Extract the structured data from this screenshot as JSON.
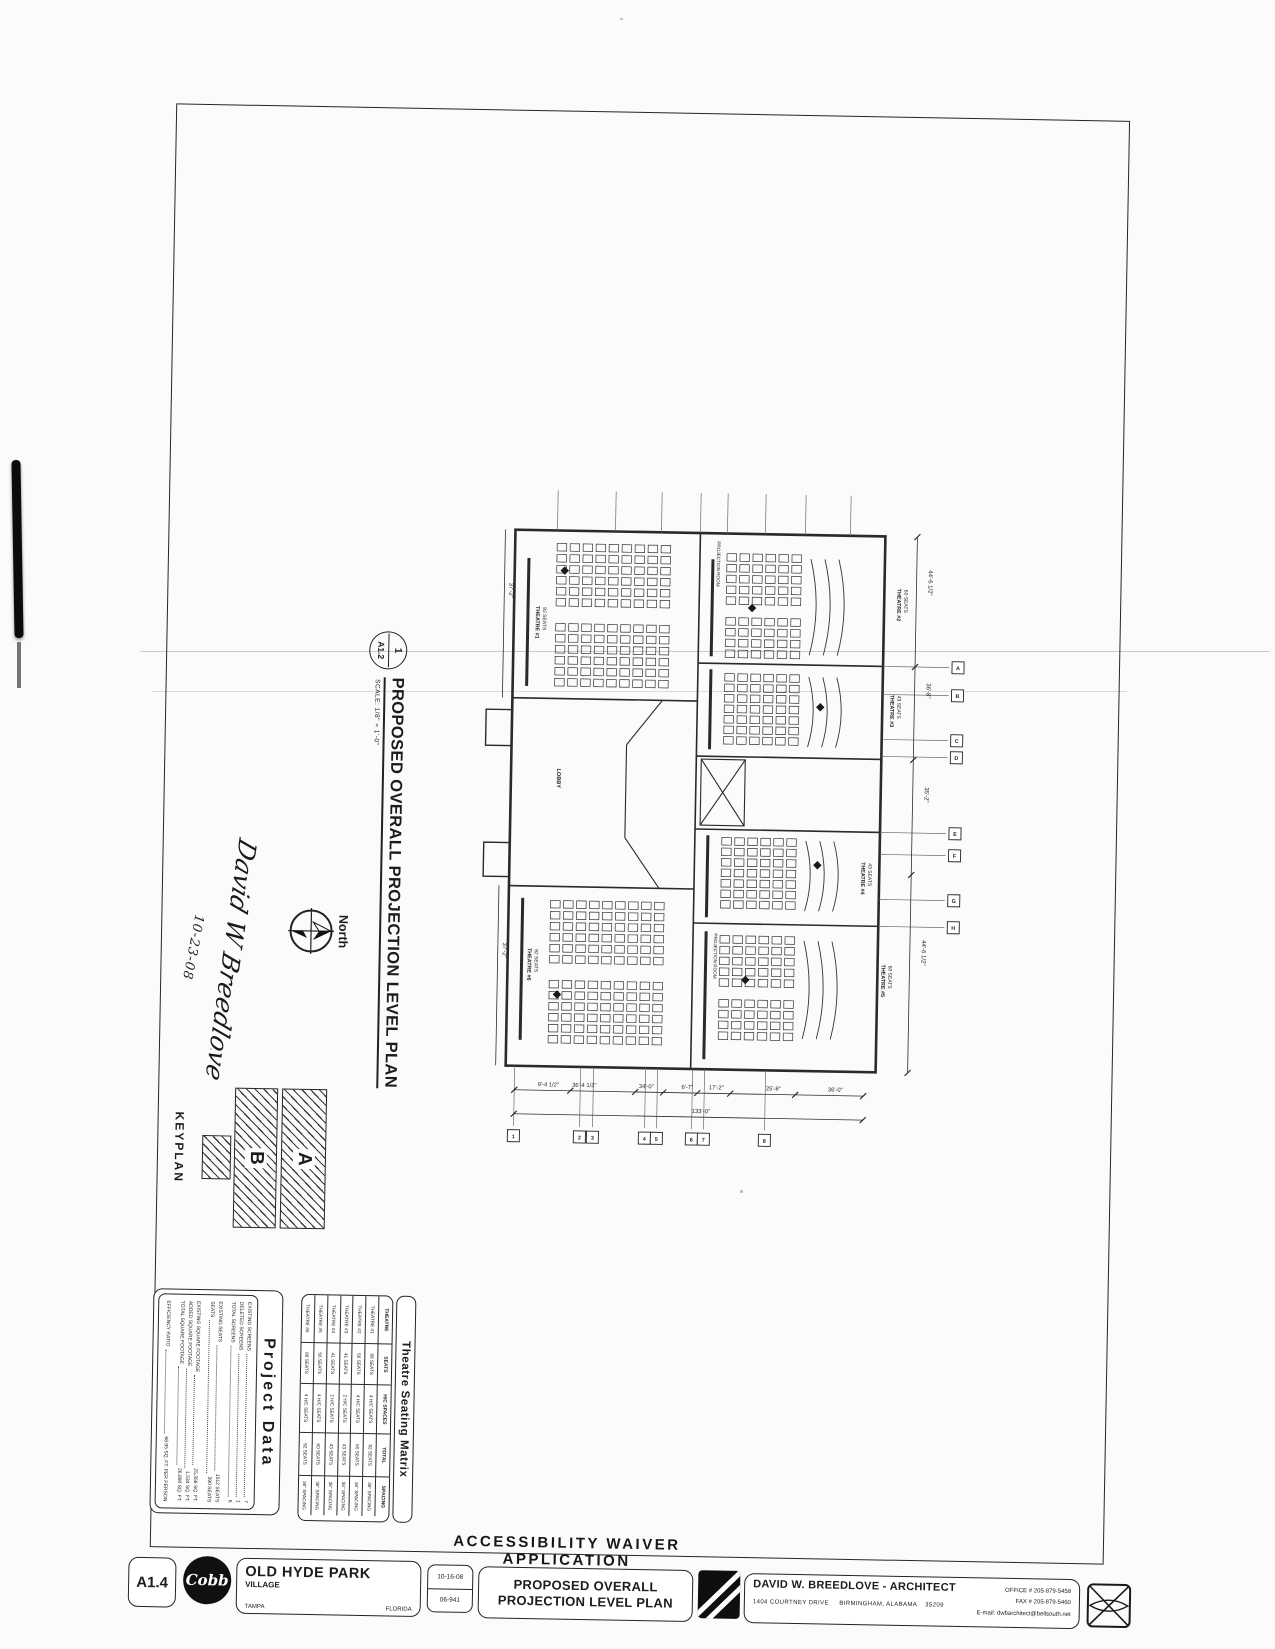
{
  "heading": "ACCESSIBILITY WAIVER APPLICATION",
  "title_block": {
    "sheet_number": "A1.4",
    "firm_logo_text": "Cobb",
    "client_name": "OLD HYDE PARK",
    "client_sub": "VILLAGE",
    "city": "TAMPA",
    "state": "FLORIDA",
    "date": "10-16-08",
    "job_number": "06-941",
    "sheet_title_line1": "PROPOSED OVERALL",
    "sheet_title_line2": "PROJECTION LEVEL PLAN",
    "architect_name": "DAVID W. BREEDLOVE - ARCHITECT",
    "architect_address": "1404 COURTNEY DRIVE",
    "architect_city": "BIRMINGHAM, ALABAMA",
    "architect_zip": "35209",
    "office_phone": "OFFICE # 205-879-5458",
    "fax_phone": "FAX # 205-879-5460",
    "email": "E-mail: dwbarchitect@bellsouth.net"
  },
  "drawing": {
    "detail_number": "1",
    "detail_sheet": "A1.2",
    "title": "PROPOSED OVERALL PROJECTION LEVEL PLAN",
    "scale": "SCALE: 1/8\" = 1'-0\"",
    "north_label": "North",
    "signature": "David W Breedlove",
    "signature_date": "10-23-08",
    "keyplan_label": "KEYPLAN",
    "keyplan_unit_a": "A",
    "keyplan_unit_b": "B"
  },
  "project_data": {
    "title": "Project Data",
    "groups": [
      [
        {
          "label": "EXISTING SCREENS",
          "value": "7"
        },
        {
          "label": "DELETED SCREENS",
          "value": "1"
        },
        {
          "label": "TOTAL SCREENS",
          "value": "6"
        }
      ],
      [
        {
          "label": "EXISTING SEATS",
          "value": "1512 SEATS"
        },
        {
          "label": "SEATS",
          "value": "390 SEATS"
        }
      ],
      [
        {
          "label": "EXISTING SQUARE FOOTAGE",
          "value": "25,356 SQ. FT."
        },
        {
          "label": "ADDED SQUARE FOOTAGE",
          "value": "1,534 SQ. FT."
        },
        {
          "label": "TOTAL SQUARE FOOTAGE",
          "value": "26,890 SQ. FT."
        }
      ],
      [
        {
          "label": "EFFICIENCY RATIO",
          "value": "68.95 SQ. FT. PER PERSON"
        }
      ]
    ]
  },
  "seating_matrix": {
    "title": "Theatre Seating Matrix",
    "columns": [
      "THEATRE",
      "SEATS",
      "H/C SPACES",
      "TOTAL",
      "SPACING"
    ],
    "rows": [
      [
        "THEATRE #1",
        "88 SEATS",
        "4 H/C SEATS",
        "92 SEATS",
        "36\" SPACING"
      ],
      [
        "THEATRE #2",
        "56 SEATS",
        "4 H/C SEATS",
        "60 SEATS",
        "36\" SPACING"
      ],
      [
        "THEATRE #3",
        "41 SEATS",
        "2 H/C SEATS",
        "43 SEATS",
        "36\" SPACING"
      ],
      [
        "THEATRE #4",
        "41 SEATS",
        "2 H/C SEATS",
        "43 SEATS",
        "36\" SPACING"
      ],
      [
        "THEATRE #5",
        "56 SEATS",
        "4 H/C SEATS",
        "60 SEATS",
        "36\" SPACING"
      ],
      [
        "THEATRE #6",
        "88 SEATS",
        "4 H/C SEATS",
        "92 SEATS",
        "36\" SPACING"
      ]
    ]
  },
  "plan": {
    "theatres": [
      {
        "name": "THEATRE #1",
        "seats": "92 SEATS"
      },
      {
        "name": "THEATRE #2",
        "seats": "60 SEATS"
      },
      {
        "name": "THEATRE #3",
        "seats": "43 SEATS"
      },
      {
        "name": "THEATRE #4",
        "seats": "43 SEATS"
      },
      {
        "name": "THEATRE #5",
        "seats": "60 SEATS"
      },
      {
        "name": "THEATRE #6",
        "seats": "92 SEATS"
      }
    ],
    "rooms": [
      "LOBBY",
      "PROJECTION ROOM",
      "PROJECTION ROOM"
    ],
    "dims_bottom": [
      "9'-4 1/2\"",
      "36'-4 1/2\"",
      "34'-0\"",
      "6'-7\"",
      "17'-2\"",
      "25'-8\"",
      "36'-0\""
    ],
    "dim_overall": "133'-0\"",
    "dims_right": [
      "44'-6 1/2\"",
      "36'-8\"",
      "35'-2\"",
      "44'-6 1/2\""
    ],
    "dims_left": [
      "37'-2\"",
      "37'-2\""
    ],
    "grid_cols": [
      "1",
      "2",
      "3",
      "4",
      "5",
      "6",
      "7",
      "8"
    ],
    "grid_rows": [
      "A",
      "B",
      "C",
      "D",
      "E",
      "F",
      "G",
      "H"
    ]
  }
}
